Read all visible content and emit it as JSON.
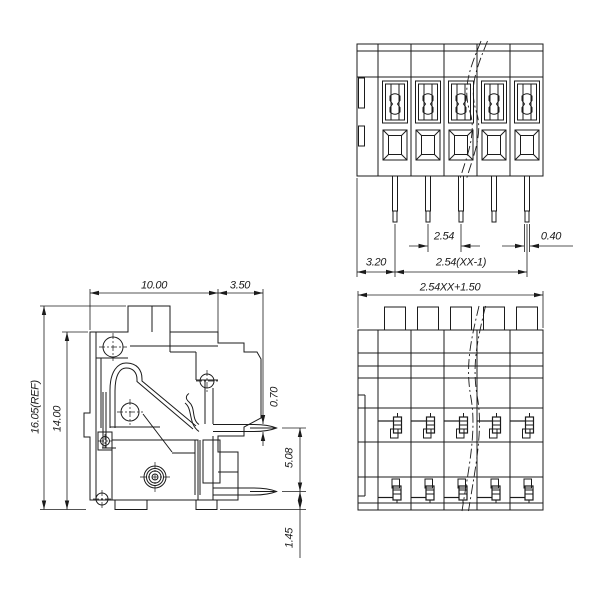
{
  "colors": {
    "background": "#ffffff",
    "line": "#1b1b1b"
  },
  "views": {
    "front": {
      "dim_pitch": "2.54",
      "dim_pin_width": "0.40",
      "dim_first_pin_offset": "3.20",
      "dim_pin_span": "2.54(XX-1)"
    },
    "side": {
      "dim_body_width": "10.00",
      "dim_flange_depth": "3.50",
      "dim_overall_height": "16.05(REF)",
      "dim_body_height": "14.00",
      "dim_pin_thickness": "0.70",
      "dim_pin_row_pitch": "5.08",
      "dim_pin_standoff": "1.45"
    },
    "bottom": {
      "dim_overall_width": "2.54XX+1.50"
    }
  }
}
